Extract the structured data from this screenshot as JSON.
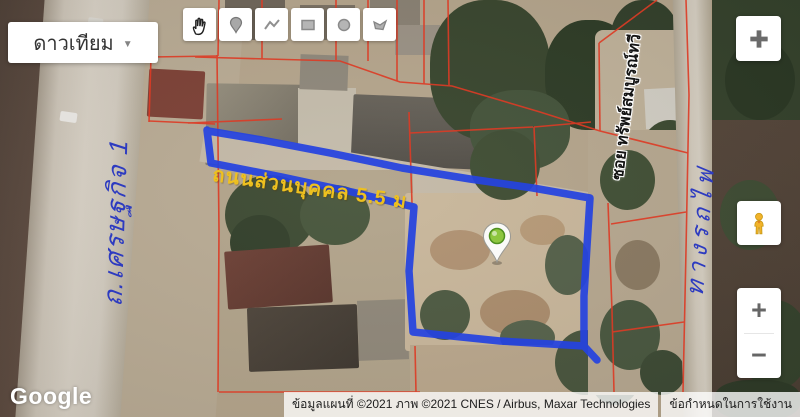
{
  "map_controls": {
    "map_type": {
      "label": "ดาวเทียม",
      "caret": "▼"
    },
    "drawing_tools": [
      {
        "name": "pan-hand",
        "icon": "hand-icon"
      },
      {
        "name": "place-marker",
        "icon": "marker-icon"
      },
      {
        "name": "draw-polyline",
        "icon": "polyline-icon"
      },
      {
        "name": "draw-rectangle",
        "icon": "rectangle-icon"
      },
      {
        "name": "draw-circle",
        "icon": "circle-icon"
      },
      {
        "name": "draw-polygon",
        "icon": "polygon-icon"
      }
    ],
    "fullscreen": {
      "icon": "fullscreen-exit-icon"
    },
    "street_view": {
      "icon": "pegman-icon"
    },
    "zoom": {
      "zoom_in": "+",
      "zoom_out": "−"
    }
  },
  "map_annotations": {
    "private_road_label": "ถนนส่วนบุคคล 5.5 ม",
    "soi_label": "ซอย ทรัพย์สมบูรณ์ทวี",
    "handwritten_left": "ถ.เศรษฐกิจ 1",
    "handwritten_right": "ทางรถไฟ",
    "marker": "plot-location-marker"
  },
  "footer": {
    "logo": "Google",
    "attribution": "ข้อมูลแผนที่ ©2021 ภาพ ©2021 CNES / Airbus, Maxar Technologies",
    "terms": "ข้อกำหนดในการใช้งาน"
  },
  "colors": {
    "boundary_blue": "#2543e0",
    "cadastral_red": "#dd3b25",
    "road_label_yellow": "#eec01f",
    "handwritten_blue": "#2d3bc0",
    "marker_green": "#8dc63f"
  }
}
